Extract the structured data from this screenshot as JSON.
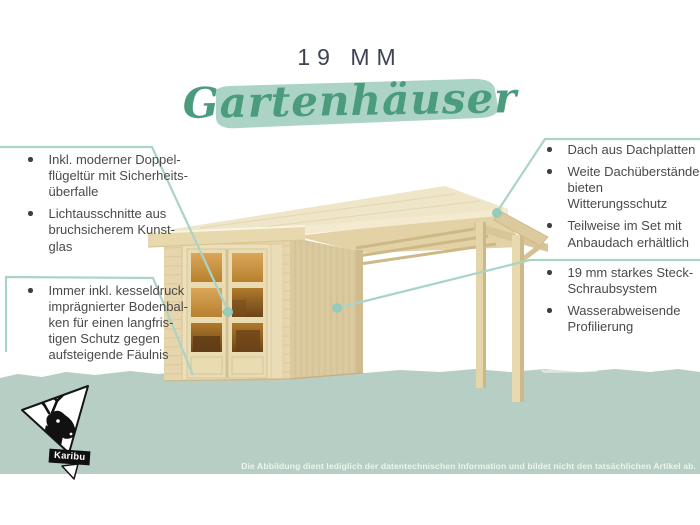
{
  "header": {
    "size_label": "19 MM",
    "title": "Gartenhäuser"
  },
  "callouts": {
    "left_top": [
      "Inkl. moderner Doppel-\nflügeltür mit Sicherheits-\nüberfalle",
      "Lichtausschnitte aus\nbruchsicherem Kunst-\nglas"
    ],
    "left_bottom": [
      "Immer inkl. kesseldruck\nimprägnierter Bodenbal-\nken für einen langfris-\ntigen Schutz gegen\naufsteigende Fäulnis"
    ],
    "right_top": [
      "Dach aus Dachplatten",
      "Weite Dachüberstände\nbieten Witterungsschutz",
      "Teilweise im Set mit\nAnbaudach erhältlich"
    ],
    "right_bottom": [
      "19 mm starkes Steck-\nSchraubsystem",
      "Wasserabweisende\nProfilierung"
    ]
  },
  "brand": {
    "name": "Karibu",
    "logo_icon": "deer-head-icon"
  },
  "footer": {
    "disclaimer": "Die Abbildung dient lediglich der datentechnischen Information und bildet nicht den tatsächlichen Artikel ab."
  },
  "colors": {
    "title_text": "#3d4354",
    "script_green": "#4a9c7d",
    "brush_green": "#a8d2c3",
    "band_green": "#b6cec3",
    "connector_teal": "#a9d4c6",
    "marker_dot": "#97cbb9",
    "body_text": "#4a4a4a",
    "wood_light": "#efe5c9",
    "wood_mid": "#e7d6ad",
    "wood_shadow": "#dbcaa0",
    "glass_amber": "#c08434"
  }
}
